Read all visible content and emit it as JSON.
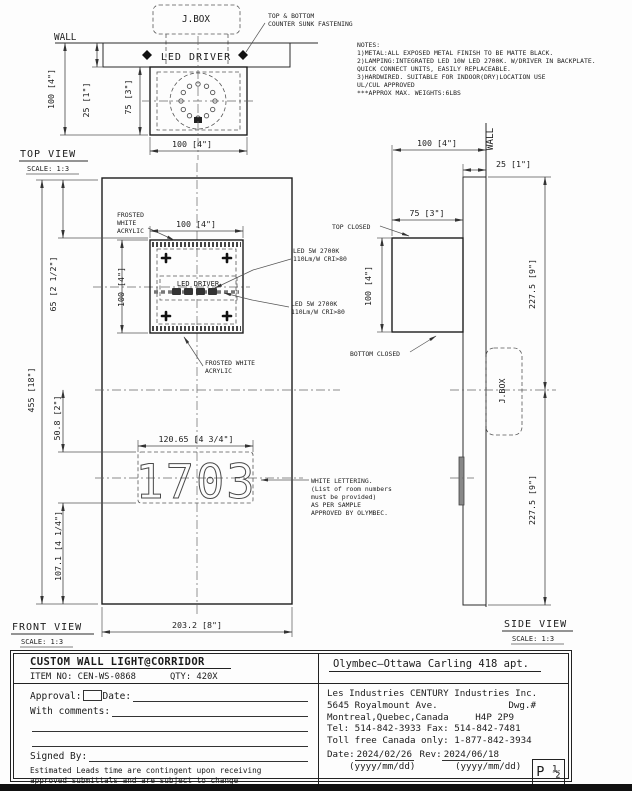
{
  "notes": {
    "heading": "NOTES:",
    "lines": [
      "1)METAL:ALL EXPOSED METAL FINISH TO BE MATTE BLACK.",
      "2)LAMPING:INTEGRATED LED 10W LED 2700K. W/DRIVER IN BACKPLATE.",
      "QUICK CONNECT UNITS, EASILY REPLACEABLE.",
      "3)HARDWIRED. SUITABLE FOR INDOOR(DRY)LOCATION USE",
      "UL/CUL APPROVED",
      "***APPROX MAX. WEIGHTS:6LBS"
    ]
  },
  "top_view": {
    "title": "TOP VIEW",
    "scale": "SCALE: 1:3",
    "wall_label": "WALL",
    "jbox_label": "J.BOX",
    "led_driver_label": "LED DRIVER",
    "fastening_note": [
      "TOP & BOTTOM",
      "COUNTER SUNK FASTENING"
    ],
    "dim_height": "100 [4\"]",
    "dim_wall_offset": "25 [1\"]",
    "dim_body_depth": "75 [3\"]",
    "dim_width": "100 [4\"]"
  },
  "front_view": {
    "title": "FRONT VIEW",
    "scale": "SCALE: 1:3",
    "frosted_label_top": [
      "FROSTED",
      "WHITE",
      "ACRYLIC"
    ],
    "frosted_label_bottom": [
      "FROSTED WHITE",
      "ACRYLIC"
    ],
    "led_driver_label": "LED DRIVER",
    "led_spec_top": [
      "LED 5W 2700K",
      "110Lm/W CRI>80"
    ],
    "led_spec_bottom": [
      "LED 5W 2700K",
      "110Lm/W CRI>80"
    ],
    "room_number": "1703",
    "lettering_note": [
      "WHITE LETTERING.",
      "(List of room numbers",
      "must be provided)",
      "AS PER SAMPLE",
      "APPROVED BY OLYMBEC."
    ],
    "dim_lamp_width": "100 [4\"]",
    "dim_lamp_height": "100 [4\"]",
    "dim_total_height": "455 [18\"]",
    "dim_top_to_lamp": "65 [2 1/2\"]",
    "dim_center_to_number": "50.8 [2\"]",
    "dim_number_to_bottom": "107.1 [4 1/4\"]",
    "dim_number_width": "120.65 [4 3/4\"]",
    "dim_panel_width": "203.2 [8\"]"
  },
  "side_view": {
    "title": "SIDE VIEW",
    "scale": "SCALE: 1:3",
    "wall_label": "WALL",
    "jbox_label": "J.BOX",
    "top_closed_label": "TOP CLOSED",
    "bottom_closed_label": "BOTTOM CLOSED",
    "dim_total_depth": "100 [4\"]",
    "dim_backplate": "25 [1\"]",
    "dim_body_depth": "75 [3\"]",
    "dim_lamp_height": "100 [4\"]",
    "dim_upper_half": "227.5 [9\"]",
    "dim_lower_half": "227.5 [9\"]"
  },
  "title_block": {
    "product_title": "CUSTOM WALL LIGHT@CORRIDOR",
    "item_no": "ITEM NO: CEN-WS-0868",
    "qty": "QTY: 420X",
    "approval_label": "Approval:",
    "date_label": "Date:",
    "comments_label": "With comments:",
    "signed_by_label": "Signed By:",
    "disclaimer": [
      "Estimated Leads time are contingent upon receiving",
      "approved submittals and are subject to change"
    ],
    "project": "Olymbec—Ottawa Carling 418 apt.",
    "company": "Les Industries CENTURY Industries Inc.",
    "address_line1": "5645 Royalmount Ave.",
    "dwg_label": "Dwg.#",
    "address_line2": "Montreal,Quebec,Canada",
    "postal_code": "H4P 2P9",
    "phone_line": "Tel: 514-842-3933 Fax: 514-842-7481",
    "tollfree_line": "Toll free Canada only: 1-877-842-3934",
    "date_field_label": "Date:",
    "date_value": "2024/02/26",
    "rev_label": "Rev:",
    "rev_value": "2024/06/18",
    "date_format": "(yyyy/mm/dd)",
    "rev_format": "(yyyy/mm/dd)",
    "page_label": "P ½"
  }
}
